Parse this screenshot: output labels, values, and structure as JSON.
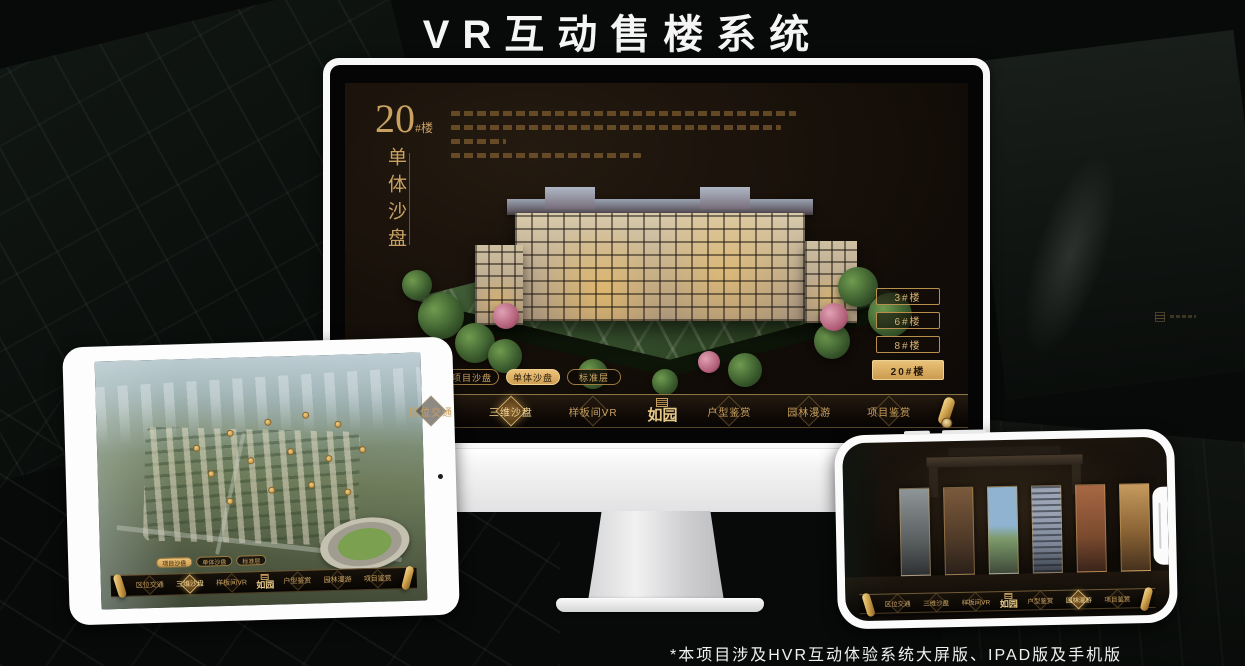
{
  "page": {
    "title": "VR互动售楼系统",
    "footnote": "*本项目涉及HVR互动体验系统大屏版、IPAD版及手机版"
  },
  "colors": {
    "gold": "#c9a262",
    "gold_bright": "#f2d694",
    "selected_tab_text": "#2a1c0b",
    "screen_background": "#130d08",
    "title_text": "#f5f5f5"
  },
  "monitor_screen": {
    "headline_number": "20",
    "headline_suffix": "#楼",
    "headline_vertical": "单体沙盘",
    "floor_buttons": [
      {
        "label": "3#楼"
      },
      {
        "label": "6#楼"
      },
      {
        "label": "8#楼"
      },
      {
        "label": "20#楼",
        "selected": true
      }
    ]
  },
  "view_tabs": [
    {
      "label": "项目沙盘"
    },
    {
      "label": "单体沙盘"
    },
    {
      "label": "标准层"
    }
  ],
  "nav": {
    "logo": "如园",
    "items": [
      {
        "label": "区位交通"
      },
      {
        "label": "三维沙盘"
      },
      {
        "label": "样板间VR"
      },
      {
        "label": "户型鉴赏"
      },
      {
        "label": "园林漫游"
      },
      {
        "label": "项目鉴赏"
      }
    ]
  }
}
